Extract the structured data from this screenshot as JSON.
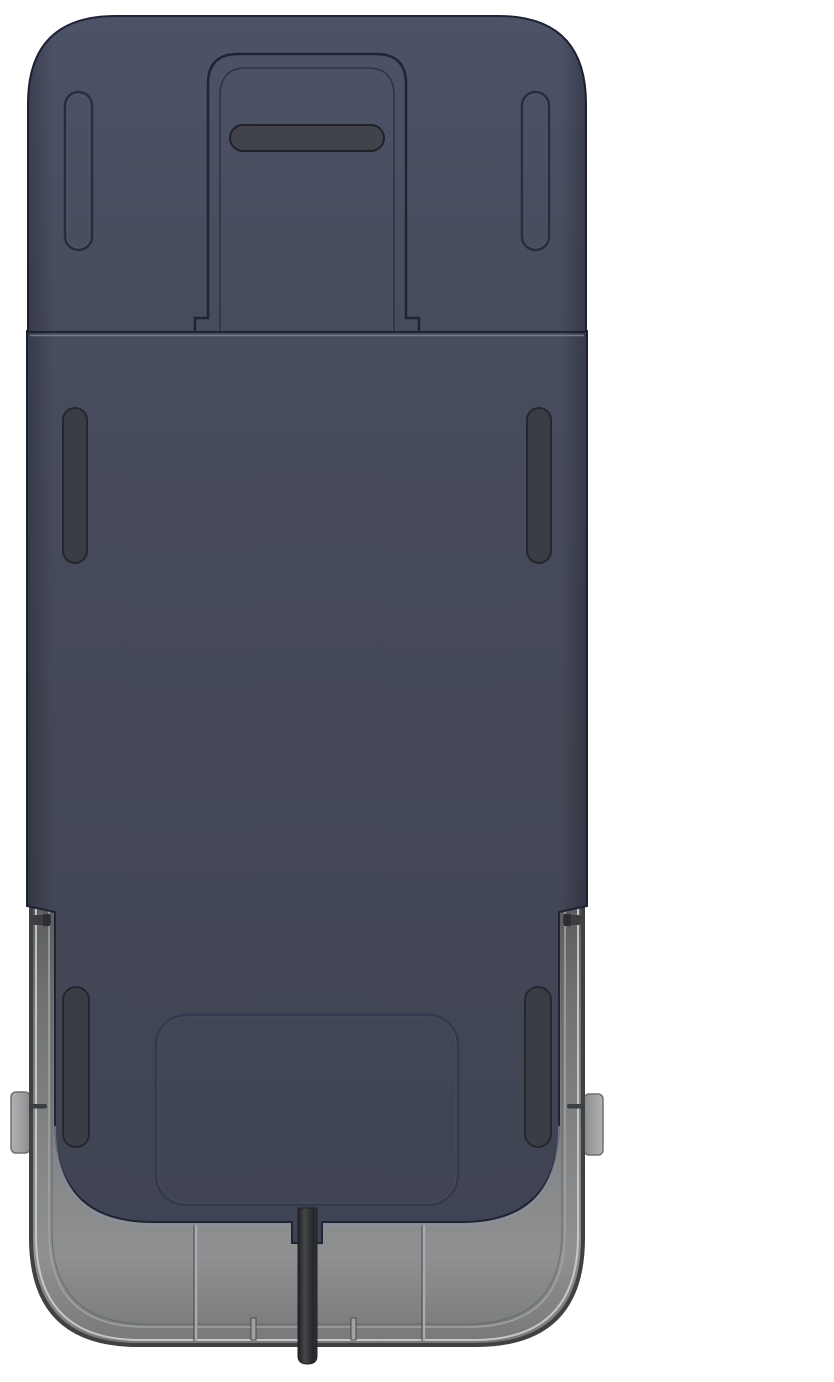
{
  "scene": {
    "alt_text": "3D product render on a white background: top-down view of a folded dark navy walking-pad style device. A navy top cap with a recessed carry-handle slot sits above a large flat navy deck with six oval foot-pad slots and a rounded access-panel outline near the bottom. A gray base tray with side rails, latch tabs and seam lines is visible around the lower portion, and a black power cable exits from the bottom center.",
    "background": "plain white",
    "visible_text": ""
  },
  "parts": {
    "top_cap": "rounded top cap panel",
    "handle_recess": "recessed channel outline in top cap",
    "handle_slot": "dark carry-handle grip slot",
    "top_foot_slots": "pair of oval groove slots on top cap",
    "main_deck": "large navy deck panel",
    "mid_foot_slots": "pair of dark oval slots mid-deck",
    "lower_foot_slots": "pair of dark oval slots near bottom",
    "access_panel": "rounded rectangle panel outline near bottom of deck",
    "base_tray": "gray base tray with rounded bottom corners",
    "side_rails": "gray rails along lower sides",
    "side_tabs": "small gray latch tabs protruding on left and right",
    "tray_seams": "two vertical seam lines on tray bottom",
    "power_cable": "black cable exiting bottom center"
  },
  "colors": {
    "background": "#ffffff",
    "cap_top": "#4d5267",
    "cap_bottom": "#464b5d",
    "body_top": "#474c5f",
    "body_mid": "#444856",
    "body_bottom": "#3f4454",
    "outline": "#1f2333",
    "edge_shade": "#10121c",
    "seam_highlight": "#878b9a",
    "notch_inner_line": "#2b3041",
    "handle_fill": "#41434a",
    "handle_outline": "#212229",
    "groove_outline": "#282c3d",
    "groove_highlight": "#5a5f73",
    "slot_fill": "#3a3d44",
    "slot_outline": "#242730",
    "hatch_outline": "#343950",
    "hatch_highlight": "#565b72",
    "navy_bottom_highlight": "#8a92a2",
    "tray_top": "#5a5c5e",
    "tray_upper": "#707274",
    "tray_mid": "#818385",
    "tray_light": "#8e9092",
    "tray_foot": "#767879",
    "tray_edge": "#3f4143",
    "tray_highlight_line": "#cbcdce",
    "tray_inner_rim": "#9fa1a3",
    "tray_rim_dark": "#5e6062",
    "seam_line_light": "#aaacae",
    "seam_line_dark": "#515356",
    "tick_fill": "#9fa1a3",
    "tick_edge": "#4a4c4e",
    "tick_dark": "#3b3e42",
    "clip_dark": "#3b3d3f",
    "clip_darker": "#2c2e31",
    "tab_light": "#b0b2b4",
    "tab_mid": "#8a8c8e",
    "tab_soft": "#9a9c9e",
    "tab_outline": "#6e7072",
    "cable_dark": "#1f2023",
    "cable_highlight": "#44464a",
    "cable_core": "#26272a",
    "cable_edge": "#313236"
  }
}
